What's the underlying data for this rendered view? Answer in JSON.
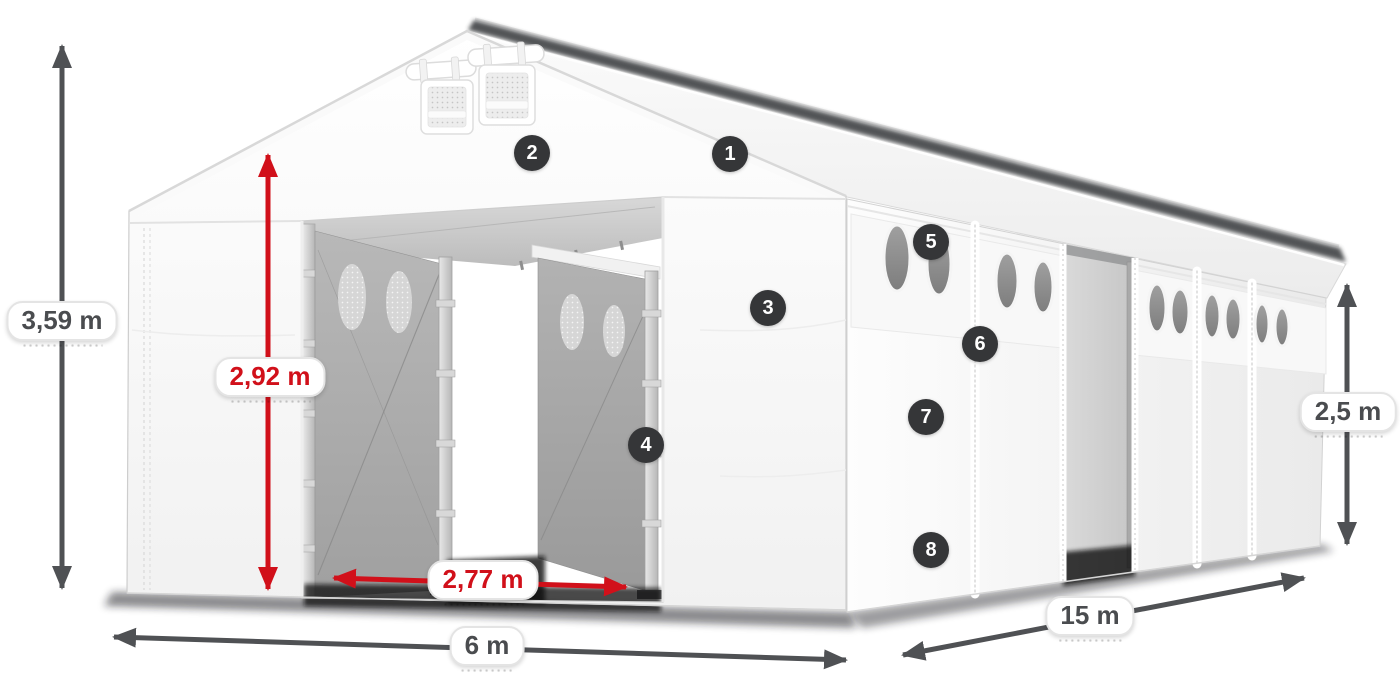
{
  "figure": {
    "type": "product-dimension-diagram",
    "subject": "White storage marquee tent 6 x 15 m with open sliding entrance",
    "background": "#ffffff"
  },
  "colors": {
    "dimension_gray": "#4f5154",
    "dimension_red": "#d1101a",
    "pill_bg": "#ffffff",
    "pill_border": "#e4e4e4",
    "badge_bg": "#353638",
    "badge_text": "#ffffff",
    "fabric_white": "#ffffff",
    "interior_gray": "#a8a8a8"
  },
  "dimensions": [
    {
      "id": "ridge-height",
      "label": "3,59 m",
      "style": "gray",
      "orientation": "vertical"
    },
    {
      "id": "entrance-height",
      "label": "2,92 m",
      "style": "red",
      "orientation": "vertical"
    },
    {
      "id": "entrance-width",
      "label": "2,77 m",
      "style": "red",
      "orientation": "horizontal"
    },
    {
      "id": "front-width",
      "label": "6 m",
      "style": "gray",
      "orientation": "horizontal"
    },
    {
      "id": "side-length",
      "label": "15 m",
      "style": "gray",
      "orientation": "diagonal"
    },
    {
      "id": "side-height",
      "label": "2,5 m",
      "style": "gray",
      "orientation": "vertical"
    }
  ],
  "callouts": [
    {
      "number": "1"
    },
    {
      "number": "2"
    },
    {
      "number": "3"
    },
    {
      "number": "4"
    },
    {
      "number": "5"
    },
    {
      "number": "6"
    },
    {
      "number": "7"
    },
    {
      "number": "8"
    }
  ]
}
